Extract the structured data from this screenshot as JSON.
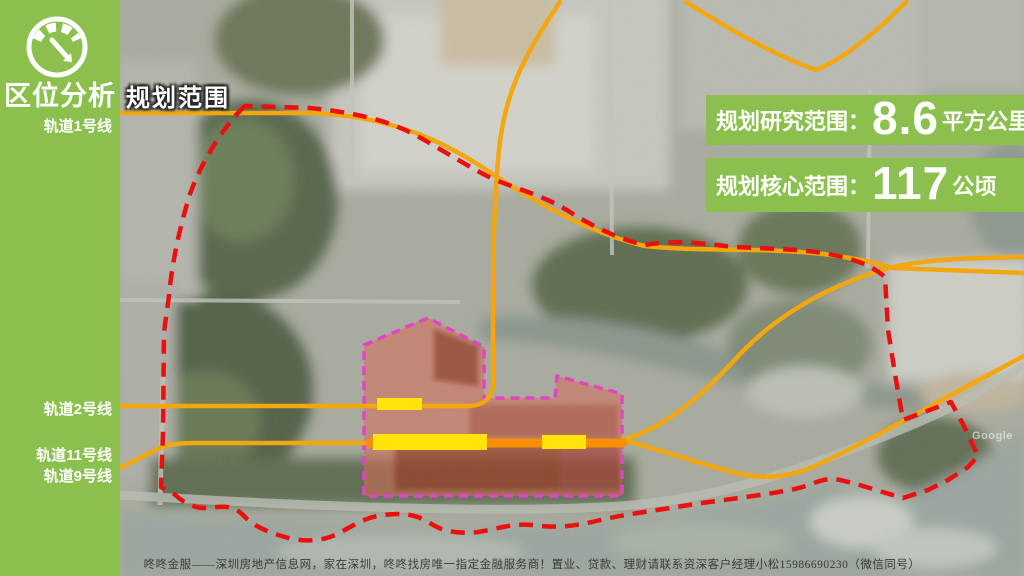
{
  "sidebar": {
    "title": "区位分析",
    "gauge_icon": "gauge-icon",
    "rail_lines": [
      "轨道1号线",
      "轨道2号线",
      "轨道11号线",
      "轨道9号线"
    ]
  },
  "map": {
    "scope_label": "规划范围",
    "imagery_watermark": "Google"
  },
  "stats": [
    {
      "label": "规划研究范围：",
      "value": "8.6",
      "unit": "平方公里"
    },
    {
      "label": "规划核心范围：",
      "value": "117",
      "unit": "公顷"
    }
  ],
  "footer": {
    "watermark": "咚咚金服——深圳房地产信息网，家在深圳，咚咚找房唯一指定金融服务商！置业、贷款、理财请联系资深客户经理小松15986690230（微信同号）"
  },
  "colors": {
    "green": "#8cc04e",
    "magenta": "#e344c6",
    "red": "#ea1010",
    "orange": "#f2a70f",
    "orange-deep": "#f79000",
    "yellow": "#ffe30a",
    "map-base": "#a7aa9c"
  }
}
